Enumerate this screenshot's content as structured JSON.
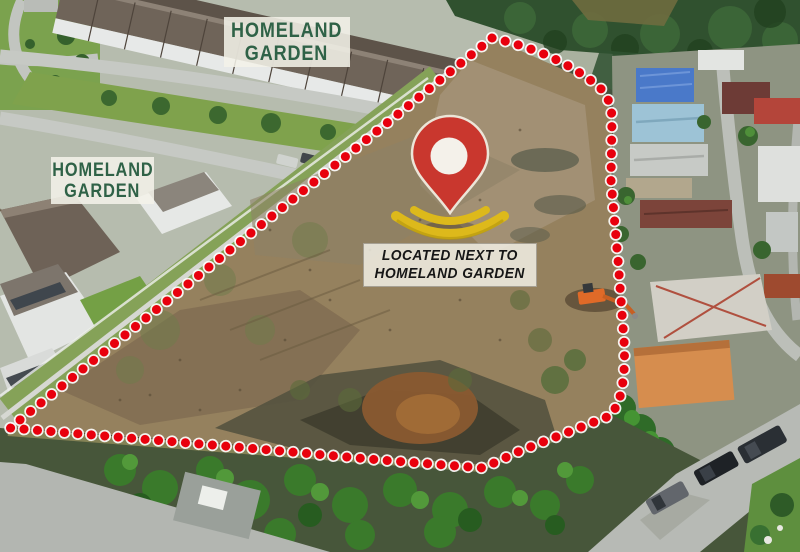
{
  "annotations": {
    "estate_label_top": {
      "line1": "HOMELAND",
      "line2": "GARDEN"
    },
    "estate_label_left": {
      "line1": "HOMELAND",
      "line2": "GARDEN"
    },
    "location_caption": {
      "line1": "LOCATED NEXT TO",
      "line2": "HOMELAND GARDEN"
    }
  },
  "icons": {
    "location_pin": "red map pin with white dot and yellow ripple base",
    "property_boundary": "red dotted outline around land plot"
  },
  "colors": {
    "boundary-red": "#e8000d",
    "boundary-halo": "#ffffff",
    "pin-red": "#c9372e",
    "pin-outline": "#ece5d8",
    "pin-inner-white": "#f4f1ea",
    "pin-base-yellow": "#ddb91b",
    "label-green": "#2f6247",
    "caption-text": "#161616",
    "label-box-bg": "#f4f2e9"
  }
}
